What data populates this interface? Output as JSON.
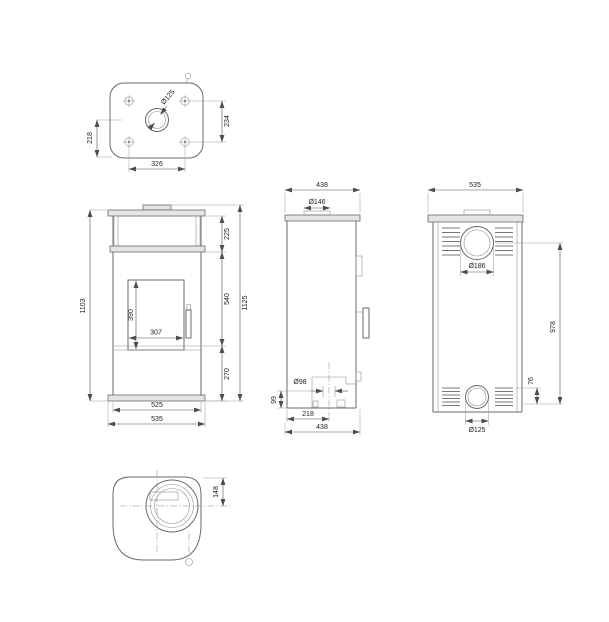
{
  "drawing": {
    "description": "Five-view dimensional technical drawing of a free-standing stove",
    "background": "#ffffff",
    "line_color": "#6a6a6a",
    "dimension_color": "#4d4d4d",
    "views": {
      "top_view": {
        "labels": {
          "flue_diameter": "Ø125",
          "left_vertical": "218",
          "right_vertical": "234",
          "bottom_horizontal": "326"
        }
      },
      "front_view": {
        "labels": {
          "body_height": "1103",
          "shelf_section_height": "225",
          "door_section_height": "540",
          "base_section_height": "270",
          "total_height": "1125",
          "glass_height": "390",
          "glass_width": "307",
          "body_width": "525",
          "total_width": "535"
        }
      },
      "side_view": {
        "labels": {
          "top_depth": "438",
          "collar_diameter": "Ø146",
          "inlet_diameter": "Ø98",
          "inlet_height": "99",
          "inlet_center_offset": "218",
          "total_depth": "438"
        }
      },
      "rear_view": {
        "labels": {
          "total_width": "535",
          "outlet_hole_diameter": "Ø186",
          "outlet_height": "978",
          "inlet_offset": "76",
          "inlet_hole_diameter": "Ø125"
        }
      },
      "bottom_view": {
        "labels": {
          "flue_center_offset": "148"
        }
      }
    }
  }
}
